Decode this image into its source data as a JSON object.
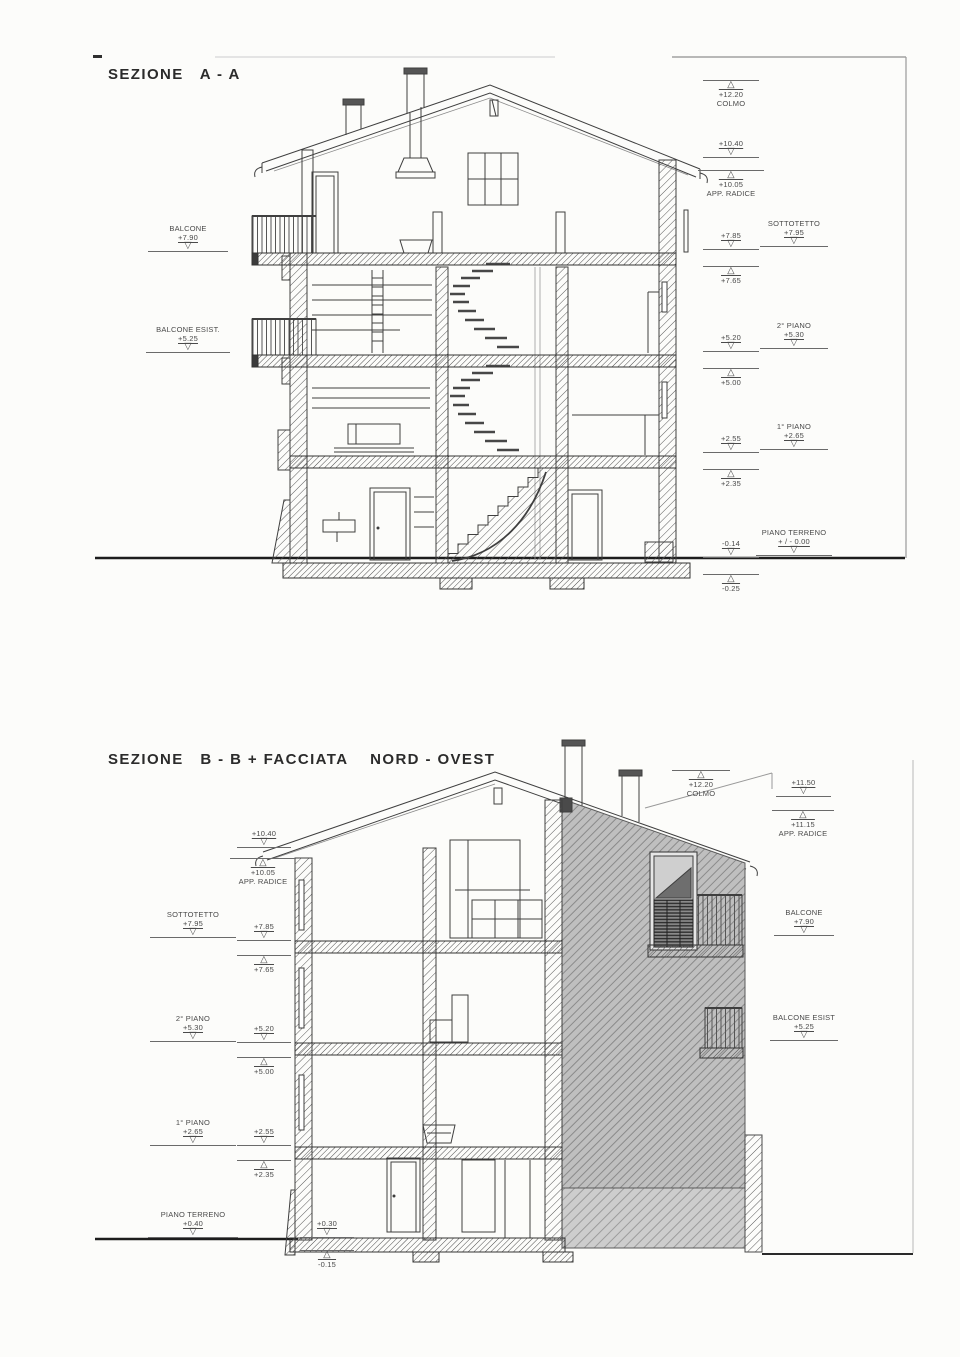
{
  "titles": {
    "section_a": "SEZIONE   A - A",
    "section_b": "SEZIONE   B - B + FACCIATA    NORD - OVEST"
  },
  "colors": {
    "paper": "#fcfcfa",
    "ink": "#3f3f3f",
    "facade_gray": "#bfbfbf"
  },
  "top": {
    "left": [
      {
        "label": "BALCONE",
        "value": "+7.90"
      },
      {
        "label": "BALCONE ESIST.",
        "value": "+5.25"
      }
    ],
    "inner_right": [
      {
        "value": "+12.20",
        "label": "COLMO"
      },
      {
        "value": "+10.40"
      },
      {
        "value": "+10.05",
        "label": "APP. RADICE"
      },
      {
        "value": "+7.85"
      },
      {
        "value": "+7.65"
      },
      {
        "value": "+5.20"
      },
      {
        "value": "+5.00"
      },
      {
        "value": "+2.55"
      },
      {
        "value": "+2.35"
      },
      {
        "value": "-0.14"
      },
      {
        "value": "-0.25"
      }
    ],
    "outer_right": [
      {
        "label": "SOTTOTETTO",
        "value": "+7.95"
      },
      {
        "label": "2° PIANO",
        "value": "+5.30"
      },
      {
        "label": "1° PIANO",
        "value": "+2.65"
      },
      {
        "label": "PIANO TERRENO",
        "value": "+ / - 0.00"
      }
    ]
  },
  "bottom": {
    "outer_left": [
      {
        "label": "SOTTOTETTO",
        "value": "+7.95"
      },
      {
        "label": "2° PIANO",
        "value": "+5.30"
      },
      {
        "label": "1° PIANO",
        "value": "+2.65"
      },
      {
        "label": "PIANO TERRENO",
        "value": "+0.40"
      }
    ],
    "inner_left": [
      {
        "value": "+10.40"
      },
      {
        "value": "+10.05",
        "label": "APP. RADICE"
      },
      {
        "value": "+7.85"
      },
      {
        "value": "+7.65"
      },
      {
        "value": "+5.20"
      },
      {
        "value": "+5.00"
      },
      {
        "value": "+2.55"
      },
      {
        "value": "+2.35"
      },
      {
        "value": "+0.30"
      },
      {
        "value": "-0.15"
      }
    ],
    "right": [
      {
        "value": "+12.20",
        "label": "COLMO"
      },
      {
        "value": "+11.50"
      },
      {
        "value": "+11.15",
        "label": "APP. RADICE"
      },
      {
        "label": "BALCONE",
        "value": "+7.90"
      },
      {
        "label": "BALCONE ESIST",
        "value": "+5.25"
      }
    ]
  }
}
